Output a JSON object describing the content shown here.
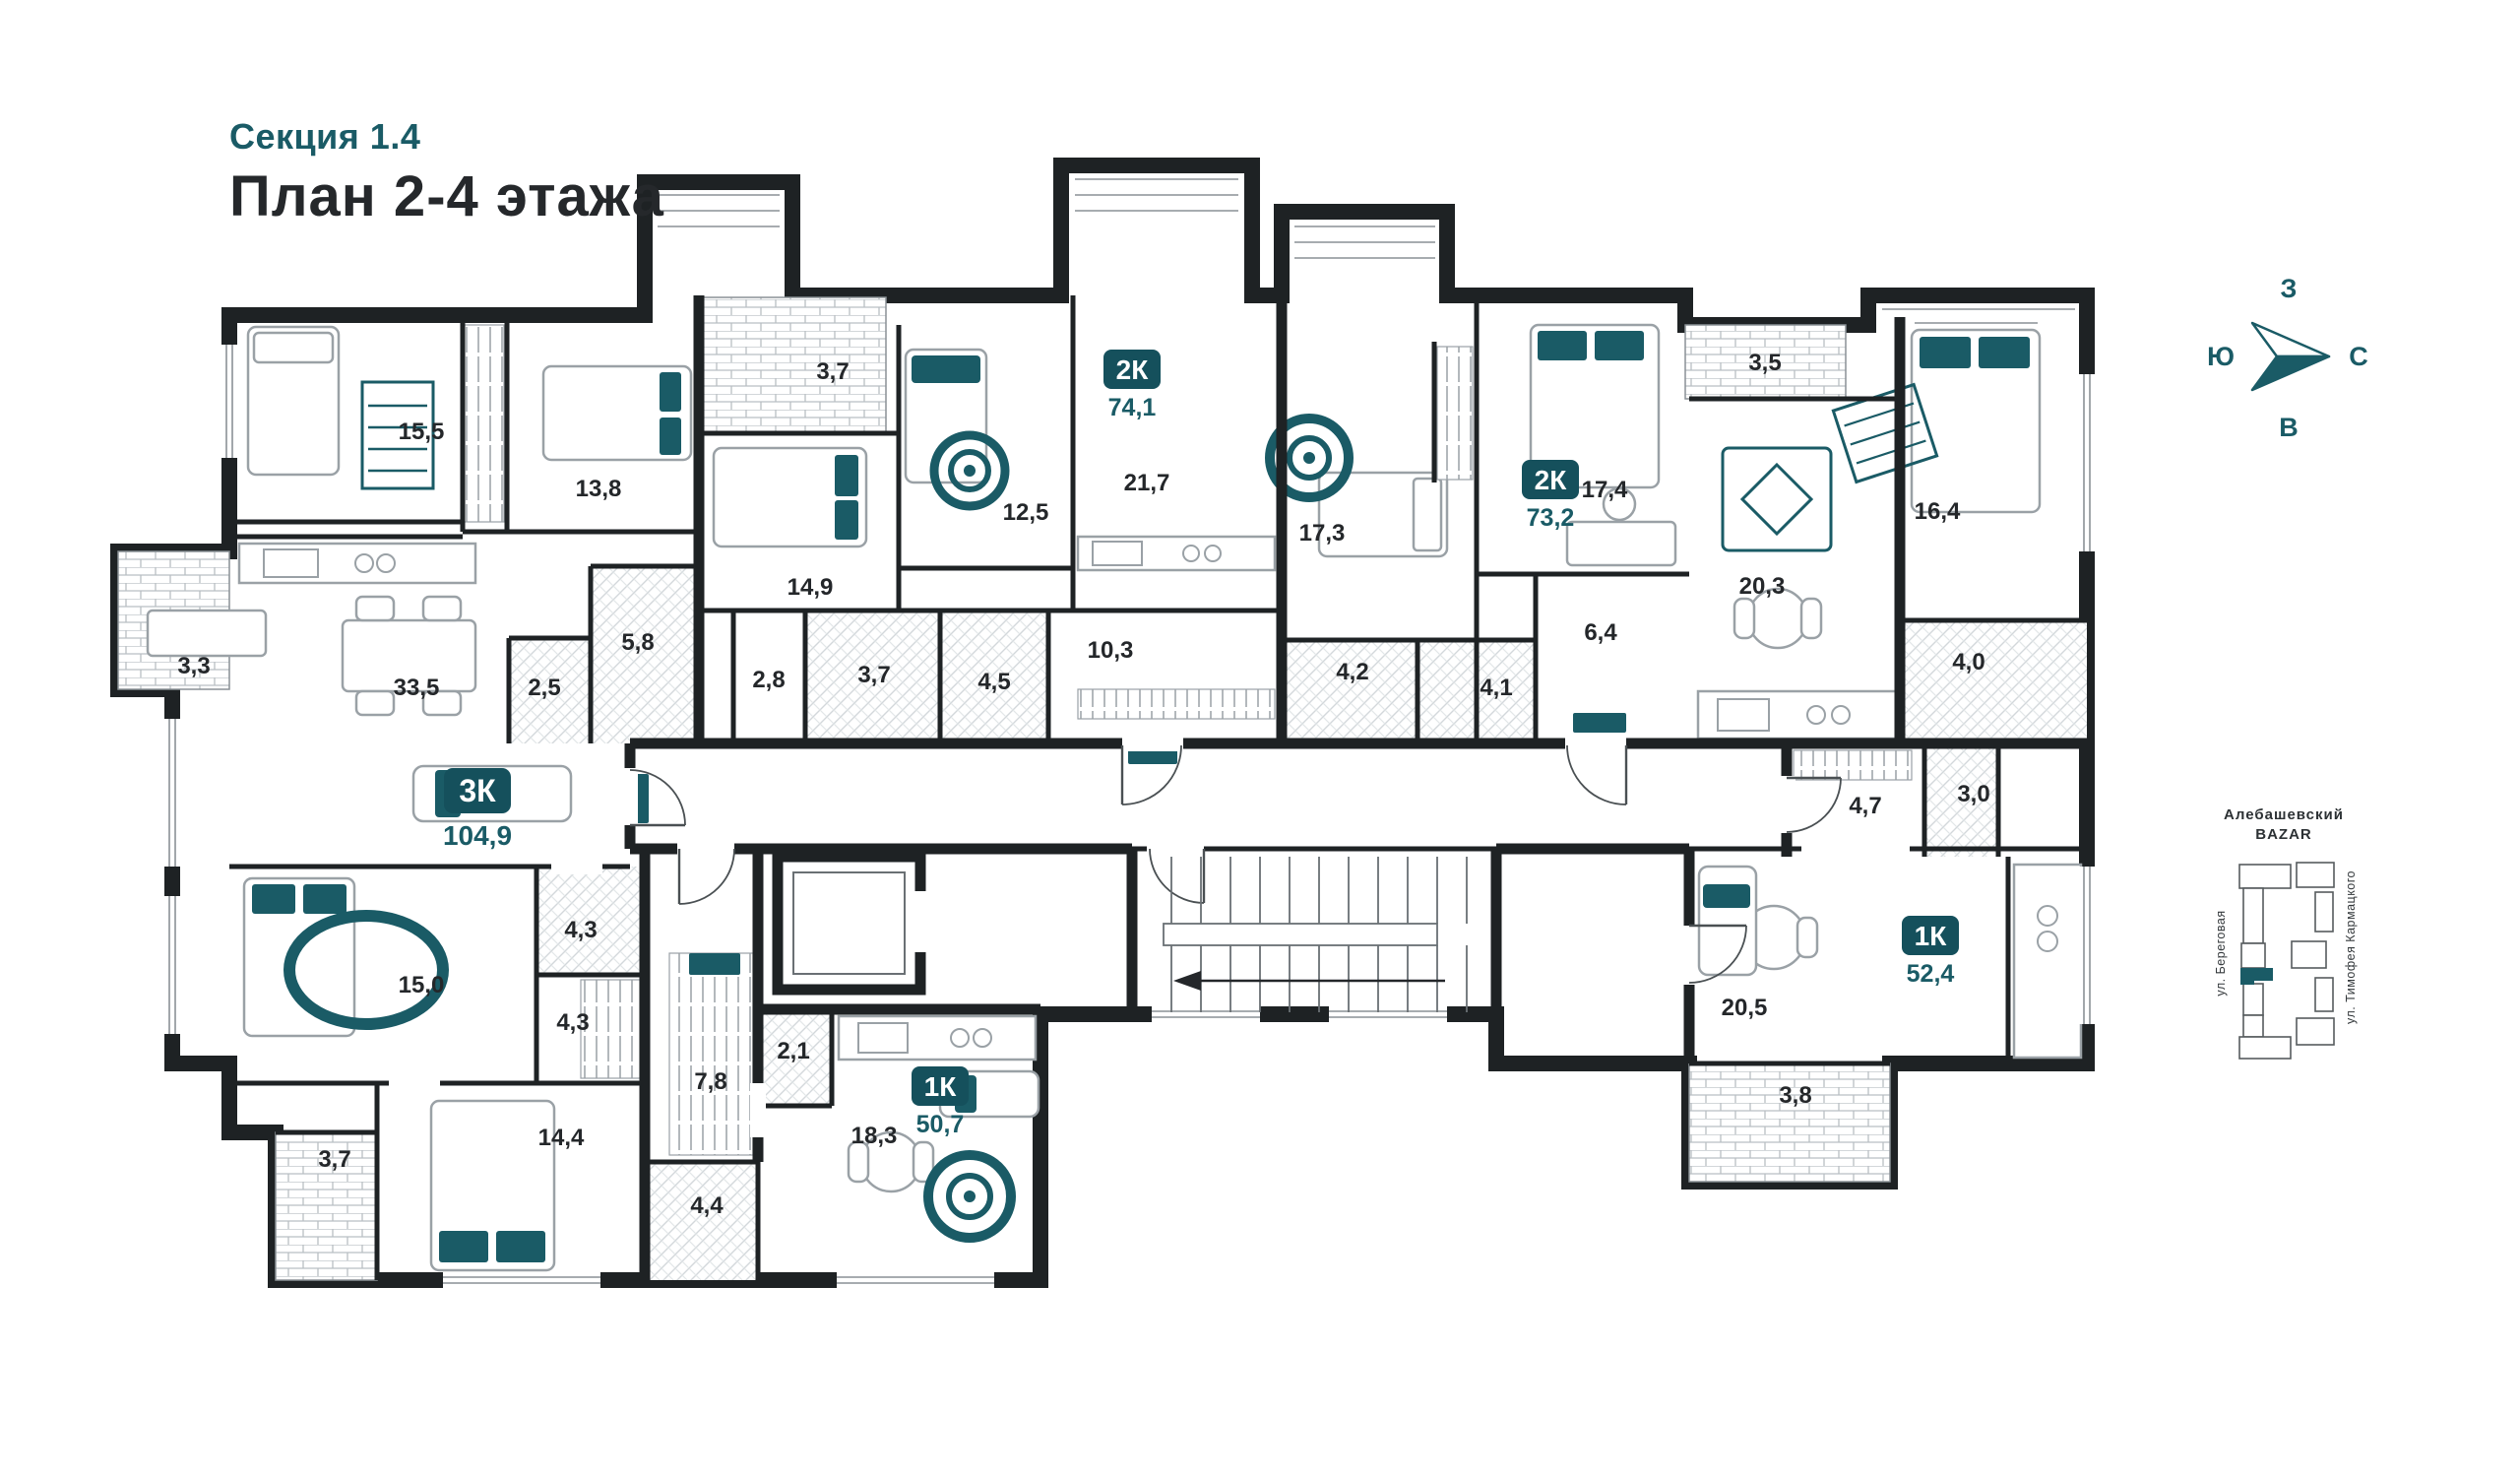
{
  "header": {
    "section": "Секция 1.4",
    "title": "План 2-4 этажа"
  },
  "colors": {
    "accent": "#1a5b66",
    "badge": "#15505c",
    "wall": "#1e2224"
  },
  "compass": {
    "top": "З",
    "left": "Ю",
    "right": "С",
    "bottom": "В"
  },
  "minimap": {
    "line1": "Алебашевский",
    "line2": "BAZAR",
    "street_left": "ул. Береговая",
    "street_right": "ул. Тимофея Кармацкого"
  },
  "apartments": [
    {
      "type": "3К",
      "area": "104,9"
    },
    {
      "type": "2К",
      "area": "74,1"
    },
    {
      "type": "2К",
      "area": "73,2"
    },
    {
      "type": "1К",
      "area": "50,7"
    },
    {
      "type": "1К",
      "area": "52,4"
    }
  ],
  "rooms": [
    {
      "id": "bedroom-15-5",
      "area": "15,5"
    },
    {
      "id": "bedroom-13-8",
      "area": "13,8"
    },
    {
      "id": "loggia-3-7",
      "area": "3,7"
    },
    {
      "id": "bedroom-12-5",
      "area": "12,5"
    },
    {
      "id": "living-21-7",
      "area": "21,7"
    },
    {
      "id": "bedroom-14-9",
      "area": "14,9"
    },
    {
      "id": "bath-5-8",
      "area": "5,8"
    },
    {
      "id": "hall-2-8",
      "area": "2,8"
    },
    {
      "id": "bath-3-7",
      "area": "3,7"
    },
    {
      "id": "bath-4-5",
      "area": "4,5"
    },
    {
      "id": "hall-10-3",
      "area": "10,3"
    },
    {
      "id": "bedroom-17-3",
      "area": "17,3"
    },
    {
      "id": "bedroom-17-4",
      "area": "17,4"
    },
    {
      "id": "balcony-3-5",
      "area": "3,5"
    },
    {
      "id": "kitchen-living-20-3",
      "area": "20,3"
    },
    {
      "id": "hall-6-4",
      "area": "6,4"
    },
    {
      "id": "bath-4-2",
      "area": "4,2"
    },
    {
      "id": "bath-4-1",
      "area": "4,1"
    },
    {
      "id": "bedroom-16-4",
      "area": "16,4"
    },
    {
      "id": "bath-4-0",
      "area": "4,0"
    },
    {
      "id": "hall-4-7",
      "area": "4,7"
    },
    {
      "id": "store-3-0",
      "area": "3,0"
    },
    {
      "id": "balcony-3-3",
      "area": "3,3"
    },
    {
      "id": "kitchen-living-33-5",
      "area": "33,5"
    },
    {
      "id": "wc-2-5",
      "area": "2,5"
    },
    {
      "id": "bedroom-15-0",
      "area": "15,0"
    },
    {
      "id": "bath-4-3",
      "area": "4,3"
    },
    {
      "id": "wardrobe-4-3",
      "area": "4,3"
    },
    {
      "id": "balcony-3-7b",
      "area": "3,7"
    },
    {
      "id": "bedroom-14-4",
      "area": "14,4"
    },
    {
      "id": "hall-7-8",
      "area": "7,8"
    },
    {
      "id": "pantry-2-1",
      "area": "2,1"
    },
    {
      "id": "kitchen-living-18-3",
      "area": "18,3"
    },
    {
      "id": "bath-4-4",
      "area": "4,4"
    },
    {
      "id": "living-20-5",
      "area": "20,5"
    },
    {
      "id": "balcony-3-8",
      "area": "3,8"
    }
  ]
}
